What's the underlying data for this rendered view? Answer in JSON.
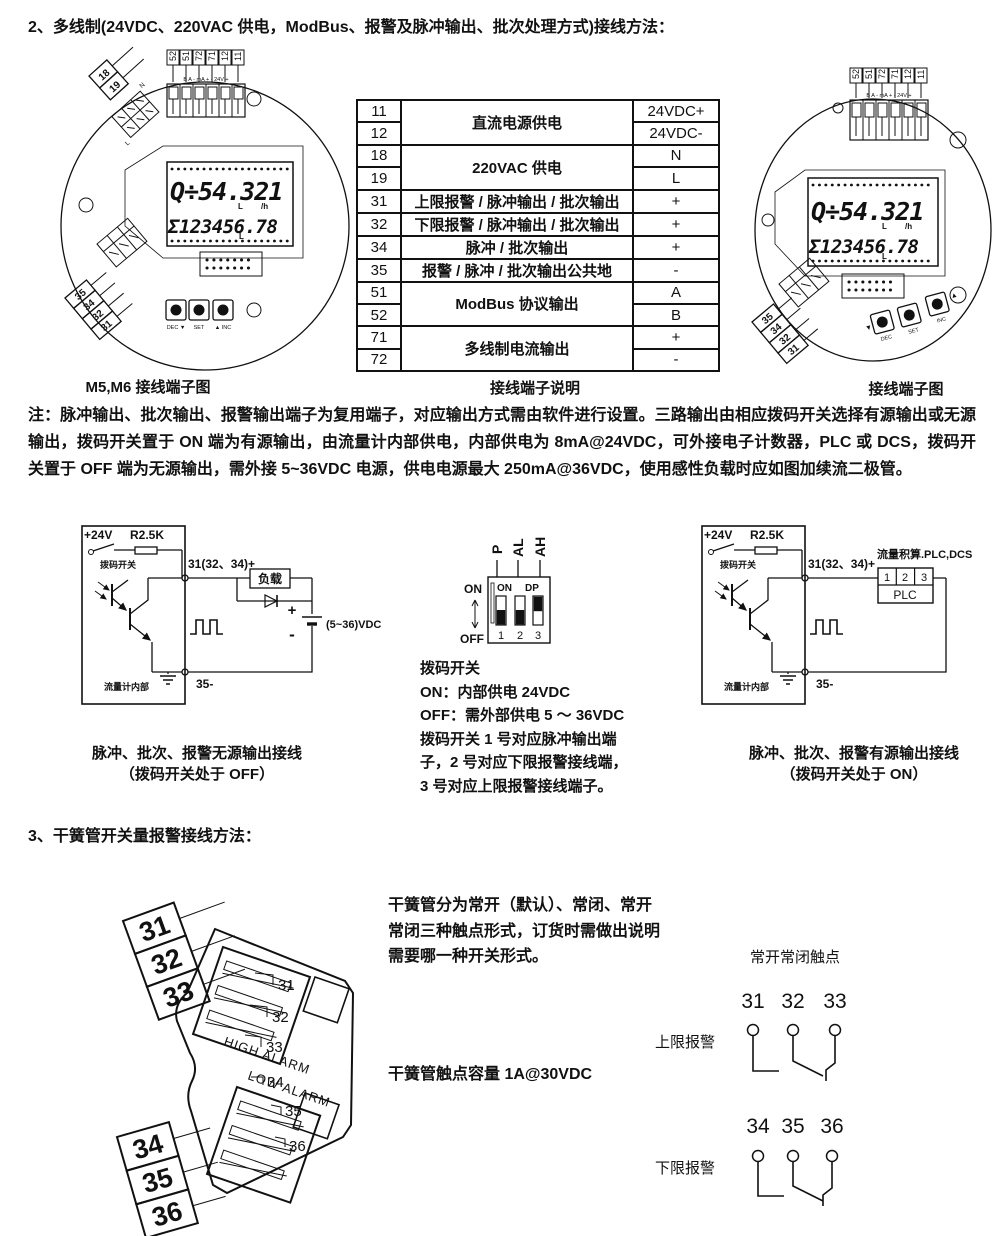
{
  "titles": {
    "section2": "2、多线制(24VDC、220VAC 供电，ModBus、报警及脉冲输出、批次处理方式)接线方法：",
    "section3": "3、干簧管开关量报警接线方法："
  },
  "note": "注：脉冲输出、批次输出、报警输出端子为复用端子，对应输出方式需由软件进行设置。三路输出由相应拨码开关选择有源输出或无源输出，拨码开关置于 ON 端为有源输出，由流量计内部供电，内部供电为 8mA@24VDC，可外接电子计数器，PLC 或 DCS，拨码开关置于 OFF 端为无源输出，需外接 5~36VDC 电源，供电电源最大 250mA@36VDC，使用感性负载时应如图加续流二极管。",
  "captions": {
    "left_diagram": "M5,M6 接线端子图",
    "table": "接线端子说明",
    "right_diagram": "接线端子图"
  },
  "terminals": {
    "top": [
      "52",
      "51",
      "72",
      "71",
      "12",
      "11"
    ],
    "strip": "B  A   - mA +   - 24V +",
    "power": [
      "18",
      "19"
    ],
    "power_nl": [
      "N",
      "L"
    ],
    "out": [
      "35",
      "34",
      "32",
      "31"
    ],
    "buttons": [
      "DEC ▼",
      "SET",
      "▲ INC"
    ],
    "buttons_right": [
      "DEC",
      "SET",
      "INC"
    ],
    "tri_down": "▼",
    "tri_up": "▲"
  },
  "lcd": {
    "line1": "Q÷54.321",
    "unit1a": "L",
    "unit1b": "/h",
    "line2": "Σ123456.78",
    "unit2": "L"
  },
  "terminal_table": {
    "rows": [
      {
        "no": "11",
        "desc": "直流电源供电",
        "val": "24VDC+"
      },
      {
        "no": "12",
        "val": "24VDC-"
      },
      {
        "no": "18",
        "desc": "220VAC 供电",
        "val": "N"
      },
      {
        "no": "19",
        "val": "L"
      },
      {
        "no": "31",
        "desc": "上限报警 / 脉冲输出 / 批次输出",
        "val": "+"
      },
      {
        "no": "32",
        "desc": "下限报警 / 脉冲输出 / 批次输出",
        "val": "+"
      },
      {
        "no": "34",
        "desc": "脉冲 / 批次输出",
        "val": "+"
      },
      {
        "no": "35",
        "desc": "报警 / 脉冲 / 批次输出公共地",
        "val": "-"
      },
      {
        "no": "51",
        "desc": "ModBus 协议输出",
        "val": "A"
      },
      {
        "no": "52",
        "val": "B"
      },
      {
        "no": "71",
        "desc": "多线制电流输出",
        "val": "+"
      },
      {
        "no": "72",
        "val": "-"
      }
    ]
  },
  "circuit": {
    "v24": "+24V",
    "r": "R2.5K",
    "dip": "拨码开关",
    "term_pos": "31(32、34)+",
    "term_neg": "35-",
    "internal": "流量计内部",
    "load": "负载",
    "battery": "(5~36)VDC",
    "plus": "+",
    "minus": "-",
    "plc_title": "流量积算.PLC,DCS",
    "plc_cells": [
      "1",
      "2",
      "3"
    ],
    "plc": "PLC",
    "passive_caption1": "脉冲、批次、报警无源输出接线",
    "passive_caption2": "（拨码开关处于 OFF）",
    "active_caption1": "脉冲、批次、报警有源输出接线",
    "active_caption2": "（拨码开关处于 ON）"
  },
  "dip": {
    "channels": [
      "P",
      "AL",
      "AH"
    ],
    "on": "ON",
    "off": "OFF",
    "box_on": "ON",
    "box_dp": "DP",
    "nums": [
      "1",
      "2",
      "3"
    ],
    "lines": [
      "拨码开关",
      "ON：内部供电 24VDC",
      "OFF：需外部供电 5 ～ 36VDC",
      "拨码开关 1 号对应脉冲输出端",
      "子，2 号对应下限报警接线端，",
      "3 号对应上限报警接线端子。"
    ]
  },
  "reed": {
    "high": "HIGH ALARM",
    "low": "LOW ALARM",
    "big1": [
      "31",
      "32",
      "33"
    ],
    "big2": [
      "34",
      "35",
      "36"
    ],
    "small1": [
      "31",
      "32",
      "33"
    ],
    "small2": [
      "34",
      "35",
      "36"
    ],
    "desc": [
      "干簧管分为常开（默认）、常闭、常开",
      "常闭三种触点形式，订货时需做出说明",
      "需要哪一种开关形式。"
    ],
    "capacity": "干簧管触点容量 1A@30VDC",
    "contacts_title": "常开常闭触点",
    "g1_label": "上限报警",
    "g2_label": "下限报警",
    "g1": [
      "31",
      "32",
      "33"
    ],
    "g2": [
      "34",
      "35",
      "36"
    ]
  }
}
